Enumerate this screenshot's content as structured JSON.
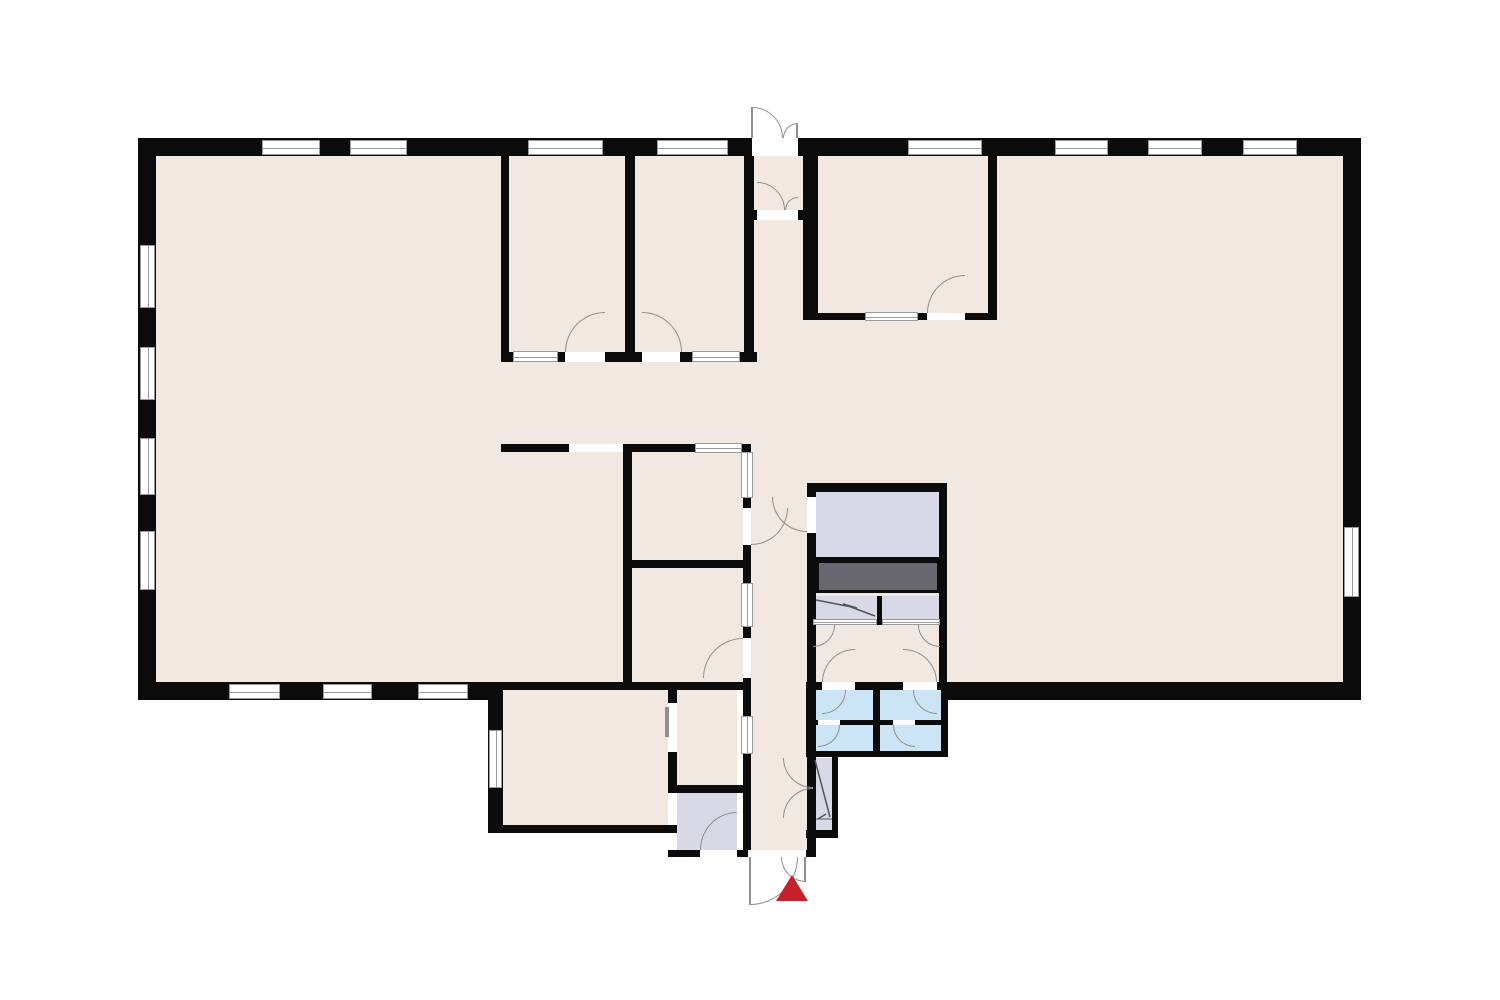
{
  "meta": {
    "type": "architectural-floor-plan",
    "canvas_width_px": 1500,
    "canvas_height_px": 1000,
    "text_labels": []
  },
  "palette": {
    "background": "#ffffff",
    "floor": "#f1e8e1",
    "wall": "#0b0b0b",
    "wet_room": "#cbe5f7",
    "utility_room": "#d9d8e7",
    "counter": "#68666f",
    "window_frame": "#9a9a9a",
    "door_arc": "#8f8f8f",
    "entrance_marker": "#c5202c"
  },
  "features": {
    "entrance_marker": {
      "shape": "triangle-pointing-up",
      "color": "#c5202c",
      "position": "below-south-entrance"
    },
    "entrances": {
      "north_double_door": 1,
      "south_double_door": 1
    },
    "wet_room_cell_count": 4,
    "utility_zone_count": 5,
    "exterior_windows": {
      "north": 8,
      "west": 4,
      "south_west": 3,
      "east": 1,
      "extension_west": 1
    },
    "interior_windows": 7,
    "open_plan": true
  }
}
